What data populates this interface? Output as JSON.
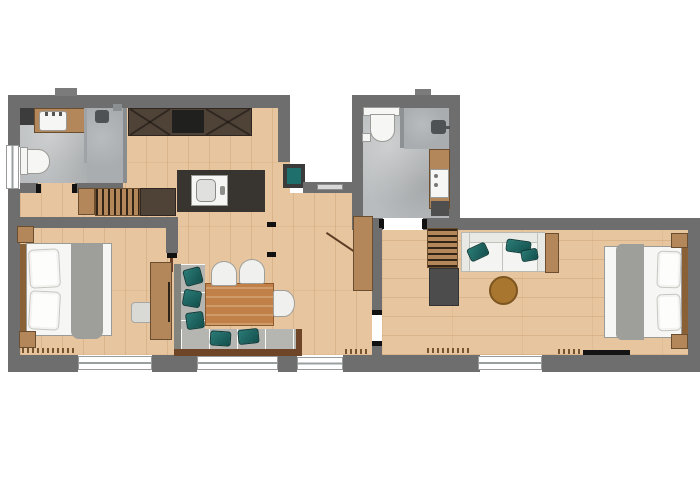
{
  "floorplan": {
    "colors": {
      "bg": "#ffffff",
      "wall": "#6e6e6e",
      "wall-dark": "#3c3c3c",
      "wood": "#e7c59e",
      "tile": "#b9bcbe",
      "tile-dark": "#a9adb0",
      "cabinet-dark": "#4f4237",
      "counter-dark": "#38342f",
      "furniture-wood": "#b3875a",
      "table-wood": "#c08048",
      "frame-wood": "#6f4527",
      "teal": "#1f6f6d",
      "bench-gray": "#b5b5b2",
      "textile-gray": "#9e9e9b",
      "white-goods": "#f6f6f4"
    },
    "rooms": [
      {
        "id": "bathroom-left",
        "floor": "tile",
        "fixtures": [
          "vanity-sink",
          "toilet",
          "shower",
          "storage-box"
        ]
      },
      {
        "id": "kitchen",
        "floor": "wood",
        "fixtures": [
          "upper-cabinets",
          "cooktop",
          "island-with-sink",
          "hanger-wardrobe",
          "cabinet"
        ]
      },
      {
        "id": "bedroom-left",
        "floor": "wood",
        "fixtures": [
          "double-bed",
          "nightstand",
          "nightstand",
          "side-table",
          "wardrobe"
        ]
      },
      {
        "id": "dining-area",
        "floor": "wood",
        "fixtures": [
          "corner-bench",
          "seat-cushions",
          "dining-table",
          "chair",
          "chair",
          "chair"
        ]
      },
      {
        "id": "corridor",
        "floor": "wood",
        "fixtures": [
          "built-in-closet",
          "service-shaft"
        ]
      },
      {
        "id": "bathroom-right",
        "floor": "tile",
        "fixtures": [
          "toilet",
          "shower",
          "washing-machine",
          "laundry-cabinet"
        ]
      },
      {
        "id": "hallway-right",
        "floor": "wood",
        "fixtures": [
          "coat-rack",
          "cabinet"
        ]
      },
      {
        "id": "living-room",
        "floor": "wood",
        "fixtures": [
          "sofa",
          "teal-cushions",
          "round-coffee-table",
          "console"
        ]
      },
      {
        "id": "bedroom-right",
        "floor": "wood",
        "fixtures": [
          "double-bed",
          "nightstand",
          "nightstand",
          "tv-board"
        ]
      }
    ],
    "openings": {
      "window_count": 6,
      "door_count": 6
    }
  }
}
